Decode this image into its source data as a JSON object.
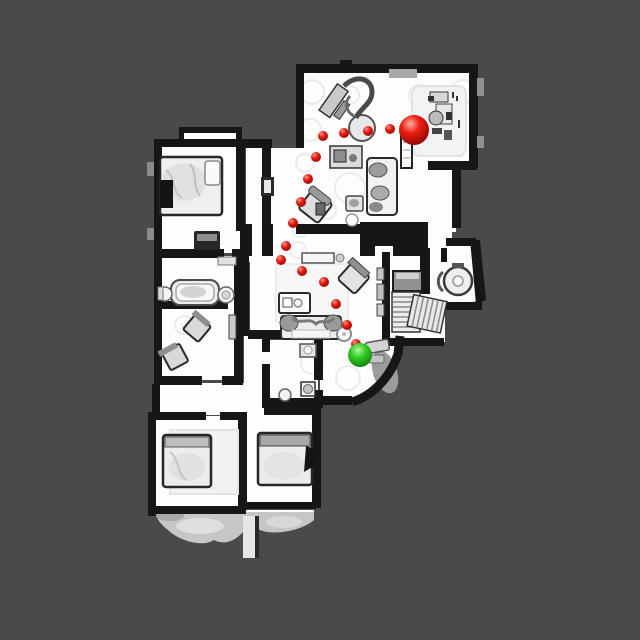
{
  "scene": {
    "description": "Top-down 3D-scanned apartment floor plan with a navigation path of red waypoint dots leading from a large red start sphere to a green goal sphere",
    "background_color": "#4a4a4a",
    "floor_color": "#fdfdfd",
    "wall_color": "#161616",
    "terrace_color": "#c6c6c6",
    "furniture_tone": "#d9d9d9"
  },
  "nav_path": {
    "start_marker": {
      "label": "start",
      "cx": 414,
      "cy": 130,
      "r": 15,
      "color": "#e01312"
    },
    "goal_marker": {
      "label": "goal",
      "cx": 360,
      "cy": 355,
      "r": 12,
      "color": "#2ec82a"
    },
    "waypoint_color": "#d51414",
    "waypoint_radius": 5,
    "waypoints": [
      [
        390,
        129
      ],
      [
        368,
        131
      ],
      [
        344,
        133
      ],
      [
        323,
        136
      ],
      [
        316,
        157
      ],
      [
        308,
        179
      ],
      [
        301,
        202
      ],
      [
        293,
        223
      ],
      [
        286,
        246
      ],
      [
        281,
        260
      ],
      [
        302,
        271
      ],
      [
        324,
        282
      ],
      [
        336,
        304
      ],
      [
        347,
        325
      ],
      [
        356,
        344
      ]
    ]
  }
}
